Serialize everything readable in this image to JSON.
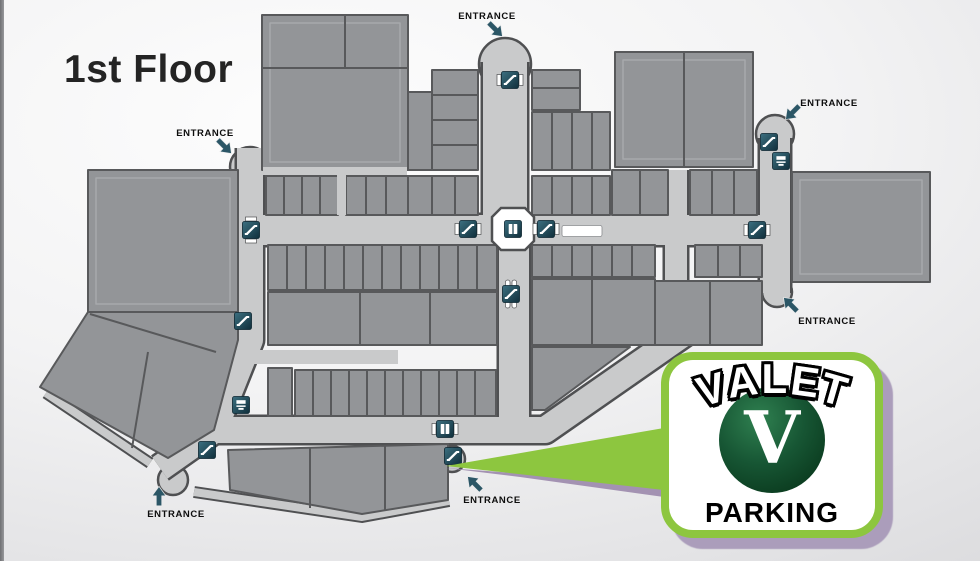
{
  "page": {
    "title": "1st Floor"
  },
  "map": {
    "entrance_labels": [
      {
        "label": "ENTRANCE",
        "text_x": 487,
        "text_y": 19,
        "arrow_x": 495,
        "arrow_y": 29,
        "arrow_rot": 45
      },
      {
        "label": "ENTRANCE",
        "text_x": 205,
        "text_y": 136,
        "arrow_x": 224,
        "arrow_y": 146,
        "arrow_rot": 45
      },
      {
        "label": "ENTRANCE",
        "text_x": 829,
        "text_y": 106,
        "arrow_x": 793,
        "arrow_y": 112,
        "arrow_rot": 135
      },
      {
        "label": "ENTRANCE",
        "text_x": 827,
        "text_y": 324,
        "arrow_x": 791,
        "arrow_y": 305,
        "arrow_rot": 225
      },
      {
        "label": "ENTRANCE",
        "text_x": 492,
        "text_y": 503,
        "arrow_x": 475,
        "arrow_y": 484,
        "arrow_rot": 225
      },
      {
        "label": "ENTRANCE",
        "text_x": 176,
        "text_y": 517,
        "arrow_x": 159,
        "arrow_y": 497,
        "arrow_rot": 270
      }
    ],
    "icons": [
      {
        "name": "escalator-icon",
        "type": "escalator-spool-h",
        "x": 510,
        "y": 80
      },
      {
        "name": "escalator-icon",
        "type": "escalator-spool-v",
        "x": 251,
        "y": 230
      },
      {
        "name": "escalator-icon",
        "type": "escalator",
        "x": 243,
        "y": 321
      },
      {
        "name": "escalator-icon",
        "type": "escalator-spool-h",
        "x": 468,
        "y": 229
      },
      {
        "name": "elevator-icon",
        "type": "elevator",
        "x": 513,
        "y": 229
      },
      {
        "name": "escalator-icon",
        "type": "escalator-spool-h",
        "x": 546,
        "y": 229
      },
      {
        "name": "kiosk-marker",
        "type": "kiosk",
        "x": 582,
        "y": 231
      },
      {
        "name": "escalator-icon",
        "type": "escalator-pills",
        "x": 511,
        "y": 294
      },
      {
        "name": "escalator-icon",
        "type": "escalator-spool-h",
        "x": 757,
        "y": 230
      },
      {
        "name": "escalator-icon",
        "type": "escalator",
        "x": 769,
        "y": 142
      },
      {
        "name": "atm-icon",
        "type": "atm",
        "x": 781,
        "y": 161
      },
      {
        "name": "escalator-icon",
        "type": "escalator",
        "x": 207,
        "y": 450
      },
      {
        "name": "atm-icon",
        "type": "atm",
        "x": 241,
        "y": 405
      },
      {
        "name": "elevator-icon",
        "type": "elevator-spool-h",
        "x": 445,
        "y": 429
      },
      {
        "name": "escalator-icon",
        "type": "escalator",
        "x": 453,
        "y": 456
      }
    ],
    "colors": {
      "store_fill": "#939598",
      "store_outline": "#58595B",
      "corridor_fill": "#C9CACB",
      "corridor_outline": "#4F5052",
      "icon_teal": "#1E4654",
      "arrow_teal": "#2B5666"
    }
  },
  "callout": {
    "title": "VALET",
    "badge_letter": "V",
    "subtitle": "PARKING",
    "accent_green": "#8DC63F",
    "badge_green": "#12502E",
    "shadow_purple": "#A999B5"
  }
}
